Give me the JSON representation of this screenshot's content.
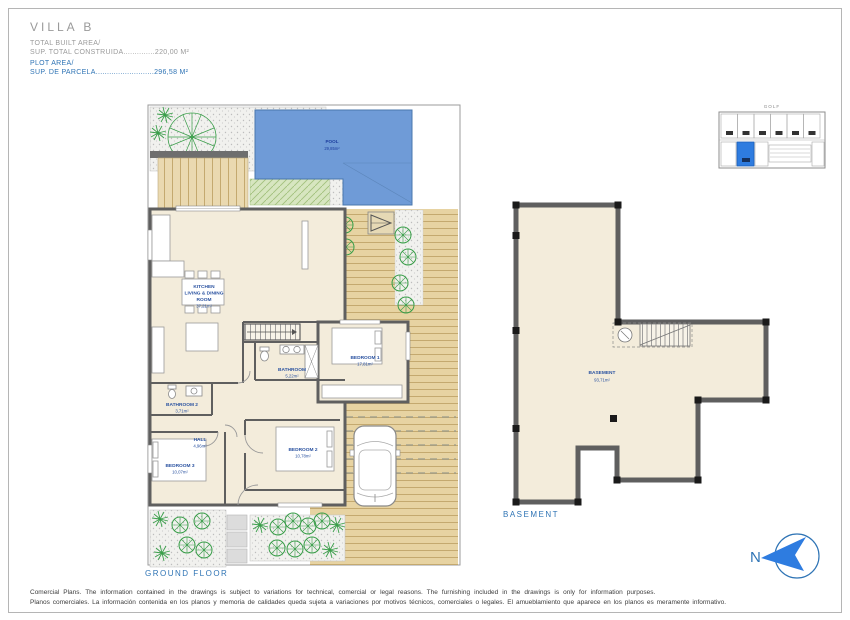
{
  "header": {
    "title": "VILLA B",
    "built_label_en": "TOTAL BUILT AREA/",
    "built_label_es": "SUP. TOTAL CONSTRUIDA",
    "built_dots": "..............",
    "built_value": "220,00 M²",
    "plot_label_en": "PLOT AREA/",
    "plot_label_es": "SUP. DE PARCELA",
    "plot_dots": "..........................",
    "plot_value": "296,58 M²"
  },
  "key_map": {
    "golf": "GOLF"
  },
  "ground_floor": {
    "caption": "GROUND FLOOR",
    "pool_label": "POOL",
    "pool_area": "29,85m²",
    "plot_label": "PLOT AREA",
    "plot_area": "296,58m²",
    "rooms": {
      "kitchen": {
        "l1": "KITCHEN",
        "l2": "LIVING & DINING",
        "l3": "ROOM",
        "area": "37,21m²"
      },
      "bathroom": {
        "name": "BATHROOM",
        "area": "5,22m²"
      },
      "bathroom2": {
        "name": "BATHROOM 2",
        "area": "3,71m²"
      },
      "hall": {
        "name": "HALL",
        "area": "4,96m²"
      },
      "bedroom1": {
        "name": "BEDROOM 1",
        "area": "17,81m²"
      },
      "bedroom2": {
        "name": "BEDROOM 2",
        "area": "10,78m²"
      },
      "bedroom3": {
        "name": "BEDROOM 3",
        "area": "10,07m²"
      }
    }
  },
  "basement": {
    "caption": "BASEMENT",
    "name": "BASEMENT",
    "area": "93,71m²"
  },
  "north": {
    "label": "N"
  },
  "footer": {
    "line_en": "Comercial Plans. The information contained in the drawings is subject to variations for technical, comercial or legal reasons. The furnishing included in the drawings is only for information purposes.",
    "line_es": "Planos comerciales. La información contenida en los planos y memoria de calidades queda sujeta a variaciones por motivos técnicos, comerciales o legales. El amueblamiento que aparece en los planos es meramente informativo."
  },
  "colors": {
    "accent_blue": "#2f74b5",
    "label_blue": "#2a52a0",
    "pool_blue": "#6f9bd7",
    "deck_tan": "#e7d3a2",
    "floor_cream": "#f3ecdb",
    "wall_gray": "#5f5f5f",
    "tree_green": "#3a9e4a",
    "highlight_blue": "#2e7ce0"
  }
}
